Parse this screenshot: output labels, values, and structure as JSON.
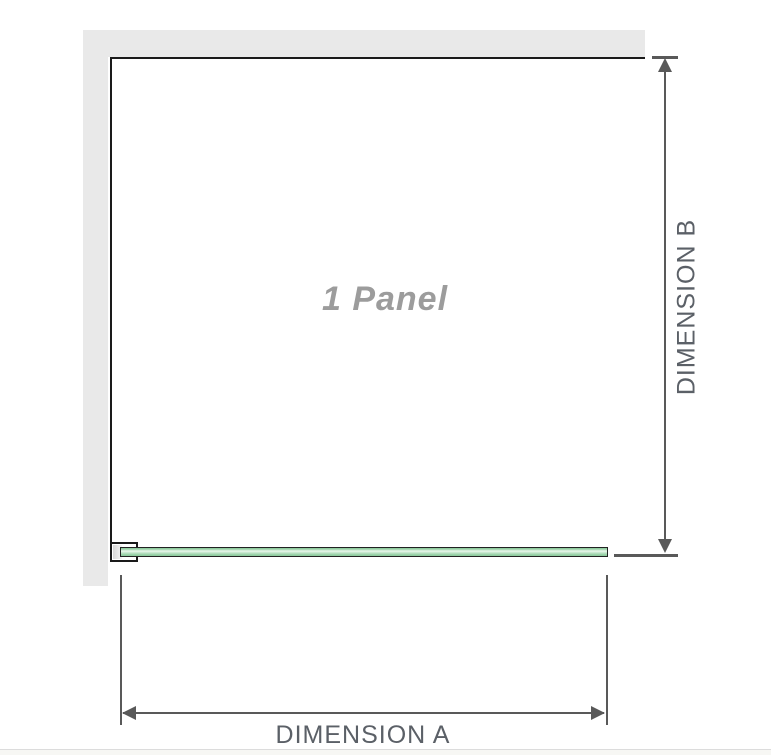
{
  "diagram": {
    "panel_label": "1 Panel",
    "dimension_a_label": "DIMENSION A",
    "dimension_b_label": "DIMENSION B",
    "colors": {
      "wall": "#e9e9e9",
      "panel_outline": "#1a1a1a",
      "glass_green_dark": "#84c594",
      "glass_green_light": "#ecf8ee",
      "dimension_line": "#595959",
      "label_text": "#5b6067",
      "panel_label_text": "#9c9c9c",
      "footer_line": "#dcdcdc",
      "footer_strip": "#f7f7f4"
    }
  }
}
